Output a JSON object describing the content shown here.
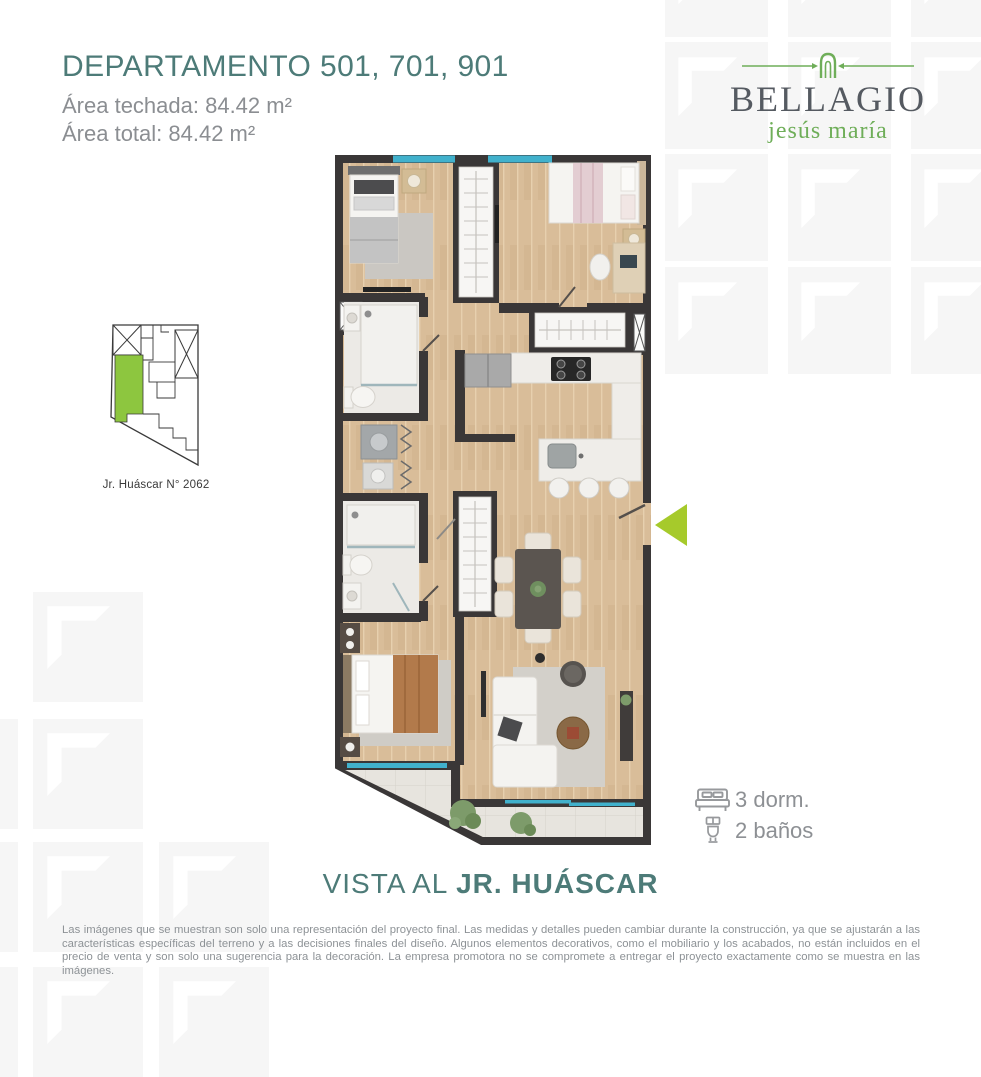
{
  "header": {
    "title": "DEPARTAMENTO 501, 701, 901",
    "area_roofed": "Área techada: 84.42 m²",
    "area_total": "Área total: 84.42 m²"
  },
  "brand": {
    "name": "BELLAGIO",
    "district": "jesús maría",
    "icon": "arch-icon"
  },
  "site_plan": {
    "address_label": "Jr. Huáscar N° 2062",
    "highlight_color": "#8dc63f"
  },
  "floor_plan": {
    "entrance_arrow_color": "#a6ca2b",
    "entrance_arrow_icon": "entrance-arrow-icon"
  },
  "features": {
    "bedrooms_label": "3 dorm.",
    "bathrooms_label": "2 baños",
    "bedrooms_icon": "bed-icon",
    "bathrooms_icon": "toilet-icon"
  },
  "view_caption": {
    "prefix": "VISTA AL ",
    "street": "JR. HUÁSCAR"
  },
  "disclaimer": "Las imágenes que se muestran son solo una representación del proyecto final. Las medidas y detalles pueden cambiar durante la construcción, ya que se ajustarán a las características específicas del terreno y a las decisiones finales del diseño. Algunos elementos decorativos, como el mobiliario y los acabados, no están incluidos en el precio de venta y son solo una sugerencia para la decoración. La empresa promotora no se compromete a entregar el proyecto exactamente como se muestra en las imágenes.",
  "colors": {
    "teal": "#4d7b78",
    "text_gray": "#8b8e92",
    "brand_dark": "#555a61",
    "brand_green": "#6fae59",
    "map_green": "#8dc63f",
    "arrow_green": "#a6ca2b",
    "pattern_tile": "#f6f6f6",
    "wall": "#3a3737",
    "wood_floor": "#d9bd99",
    "window_blue": "#41b1cc"
  }
}
